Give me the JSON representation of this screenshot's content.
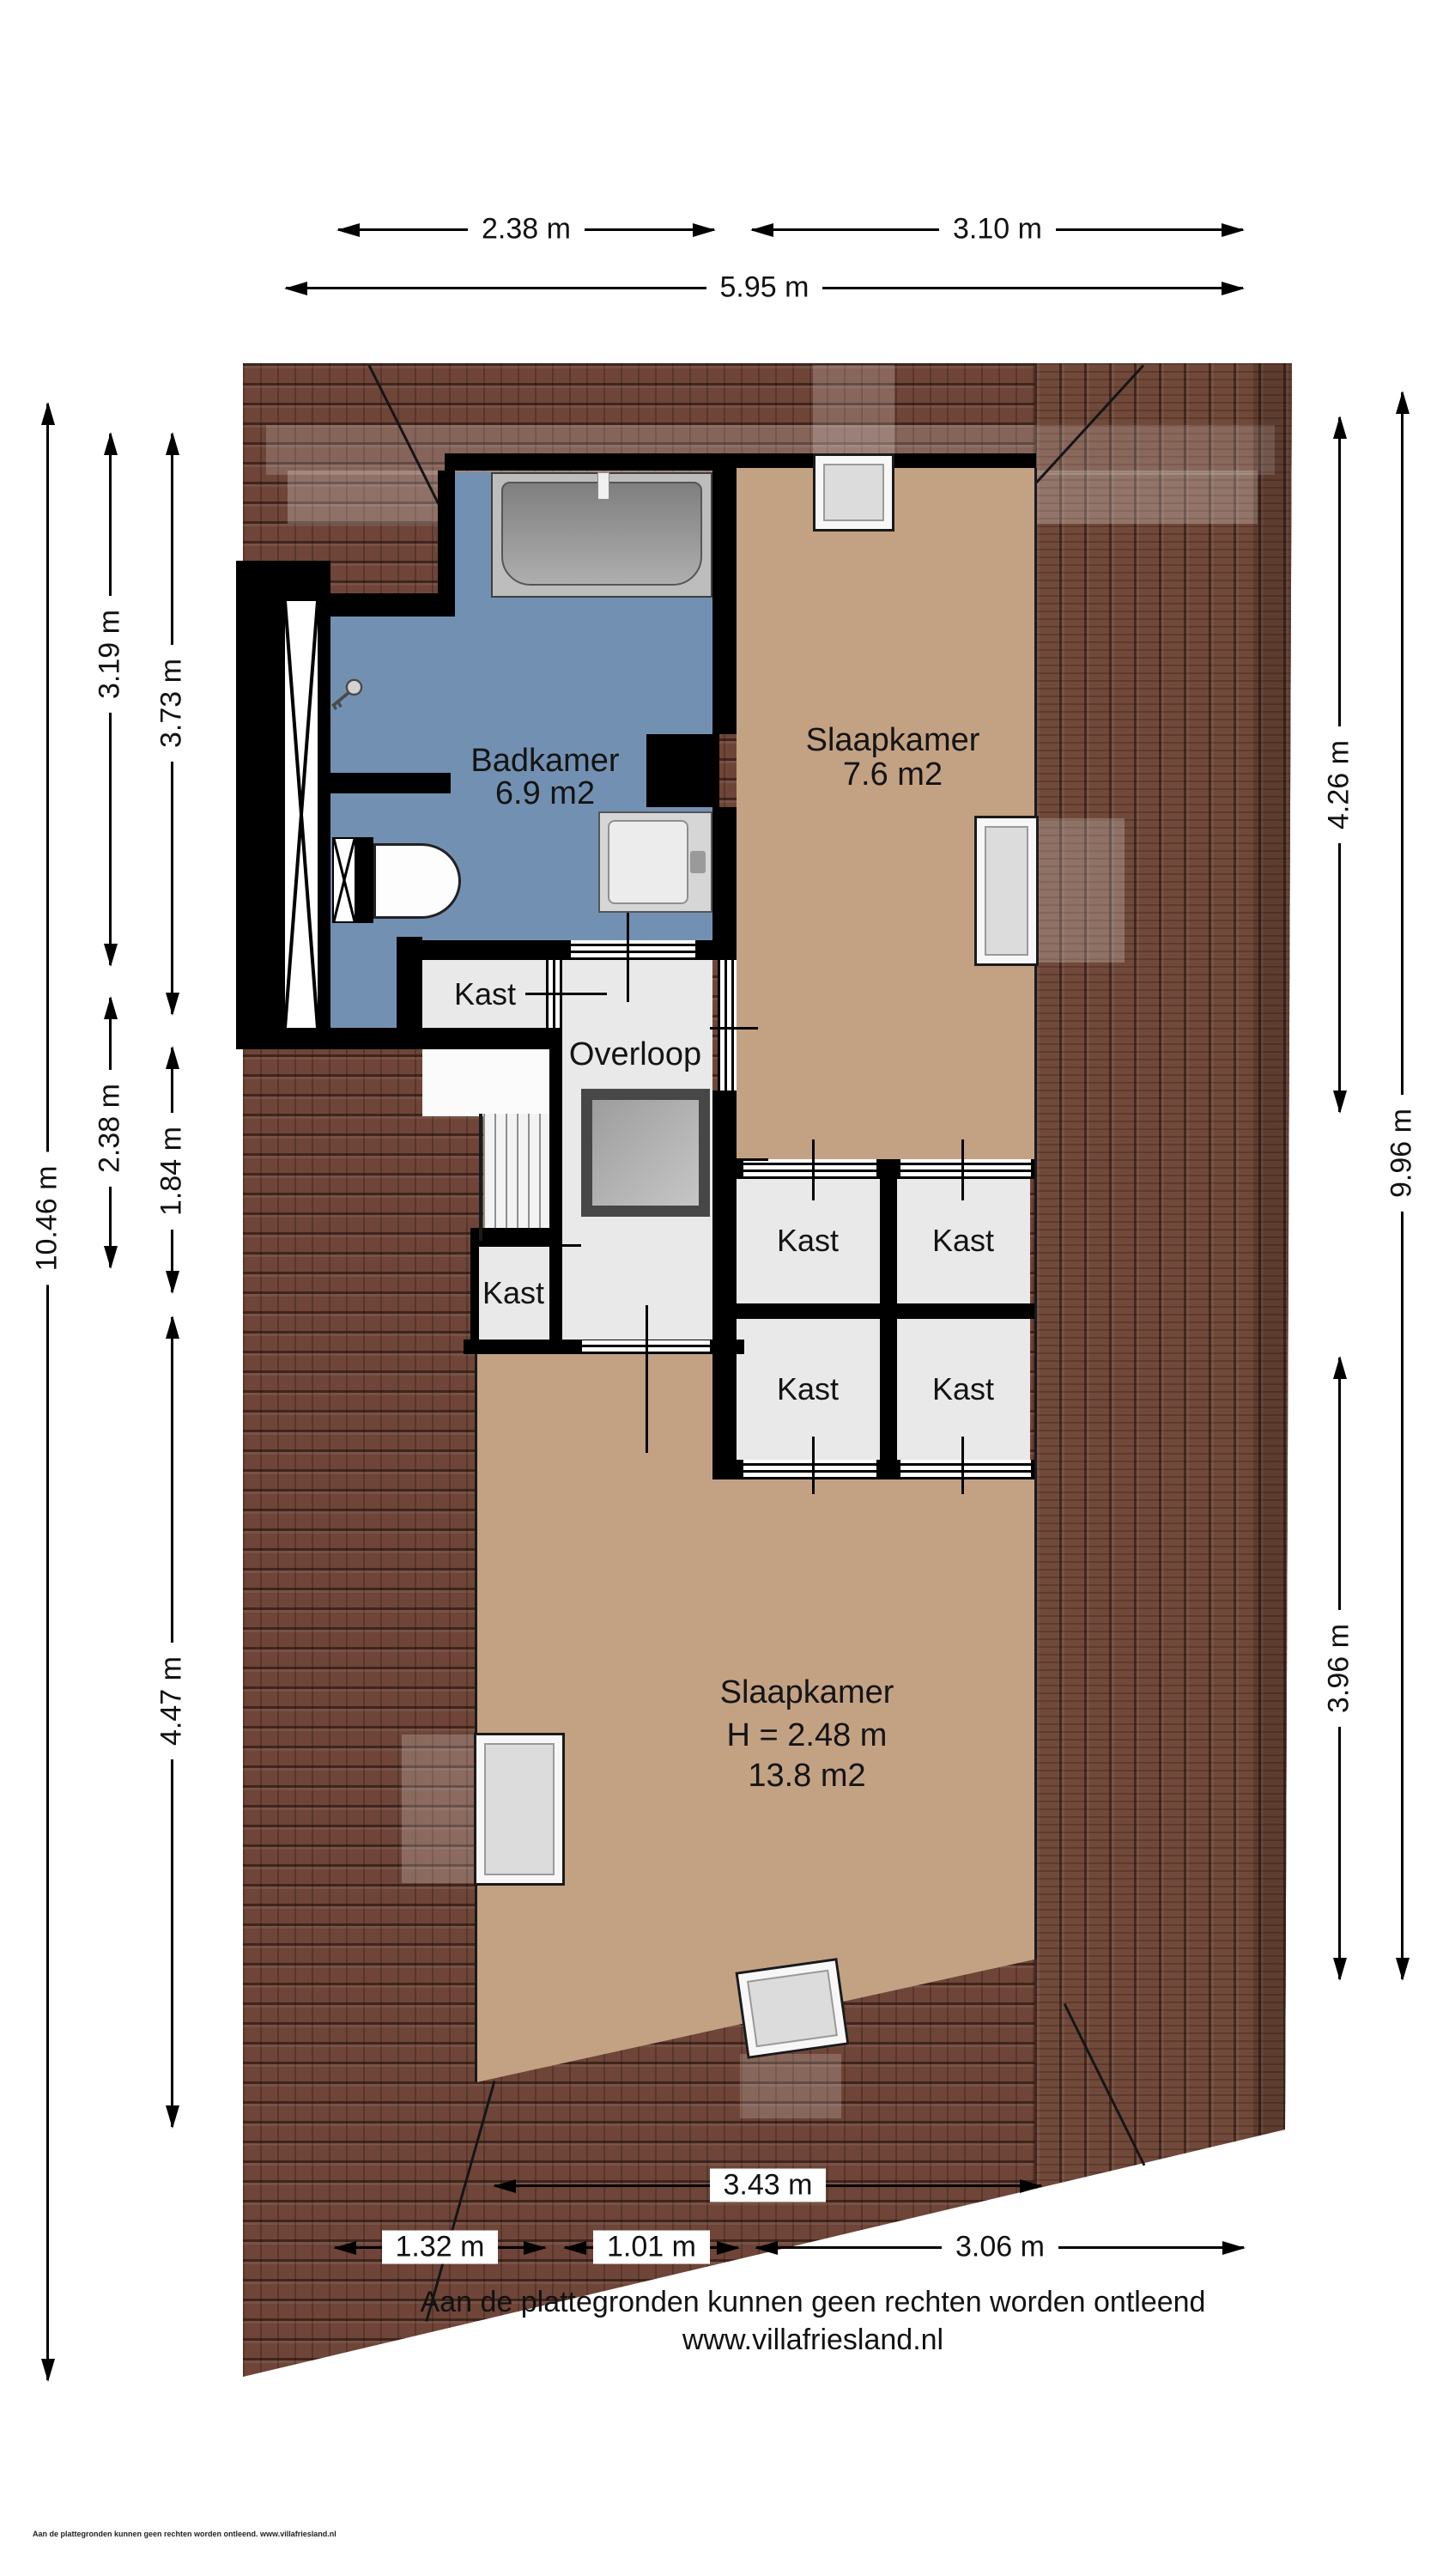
{
  "plan": {
    "rooms": {
      "badkamer": {
        "name": "Badkamer",
        "area": "6.9 m2"
      },
      "slaapkamer_boven": {
        "name": "Slaapkamer",
        "area": "7.6 m2"
      },
      "overloop": {
        "name": "Overloop"
      },
      "kast": {
        "name": "Kast"
      },
      "slaapkamer_beneden": {
        "name": "Slaapkamer",
        "height": "H = 2.48 m",
        "area": "13.8 m2"
      }
    }
  },
  "dimensions": {
    "top": [
      {
        "label": "2.38 m"
      },
      {
        "label": "3.10 m"
      },
      {
        "label": "5.95 m"
      }
    ],
    "left": [
      {
        "label": "10.46 m"
      },
      {
        "label": "3.19 m"
      },
      {
        "label": "3.73 m"
      },
      {
        "label": "2.38 m"
      },
      {
        "label": "1.84 m"
      },
      {
        "label": "4.47 m"
      }
    ],
    "right": [
      {
        "label": "4.26 m"
      },
      {
        "label": "9.96 m"
      },
      {
        "label": "3.96 m"
      }
    ],
    "bottom": [
      {
        "label": "3.43 m"
      },
      {
        "label": "1.32 m"
      },
      {
        "label": "1.01 m"
      },
      {
        "label": "3.06 m"
      }
    ]
  },
  "footer": {
    "disclaimer": "Aan de plattegronden kunnen geen rechten worden ontleend",
    "website": "www.villafriesland.nl",
    "corner_note": "Aan de plattegronden kunnen geen rechten worden ontleend. www.villafriesland.nl"
  },
  "colors": {
    "bathroom_floor": "#7291b2",
    "bedroom_floor": "#c3a284",
    "closet_floor": "#e9e9e9",
    "wall": "#000000",
    "roof_tile": "#6e4538",
    "roof_tile_side": "#71493a",
    "void_border": "#474747",
    "fixture_gray": "#bdbdbd"
  }
}
